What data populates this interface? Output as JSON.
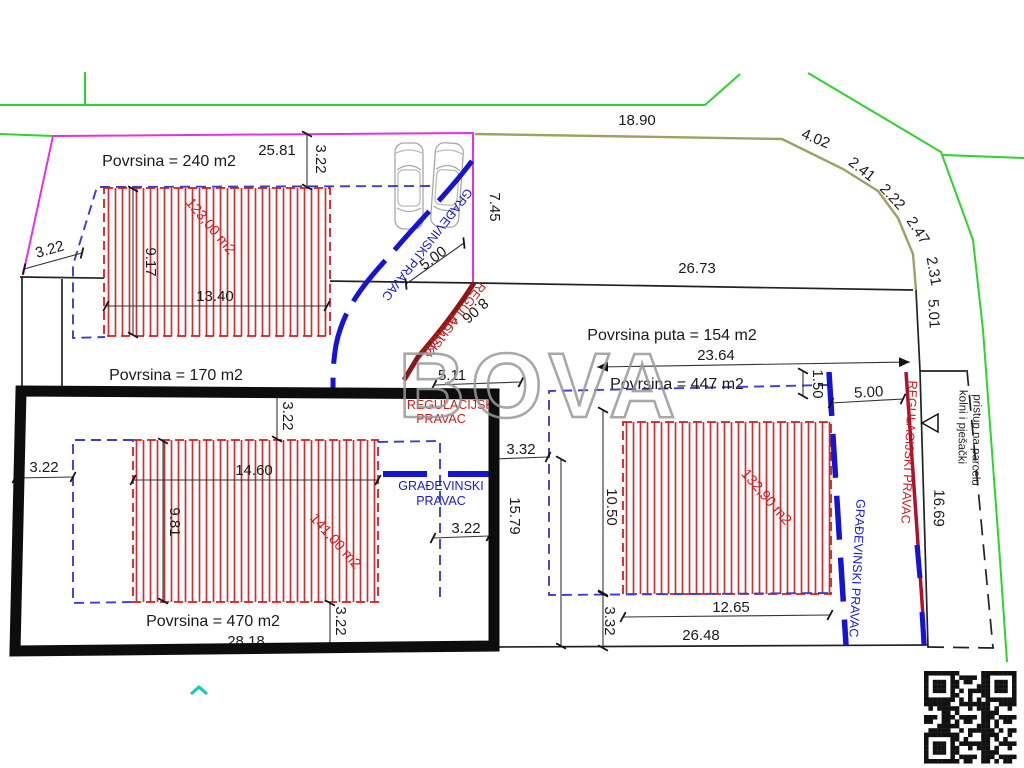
{
  "watermark": "BOVA",
  "parcels": {
    "p240": "Povrsina = 240 m2",
    "p170": "Povrsina = 170 m2",
    "p470": "Povrsina = 470 m2",
    "p447": "Povrsina = 447 m2",
    "road": "Povrsina puta = 154 m2"
  },
  "buildings": {
    "b123": "123,00 m2",
    "b141": "141,00 m2",
    "b132": "132,90 m2"
  },
  "dims": {
    "d2581": "25.81",
    "d322_top": "3.22",
    "d322_left": "3.22",
    "d1340": "13.40",
    "d917": "9.17",
    "d745": "7.45",
    "d500_diag": "5.00",
    "d806": "8.06",
    "d1890": "18.90",
    "d402": "4.02",
    "d241": "2.41",
    "d222": "2.22",
    "d247": "2.47",
    "d231": "2.31",
    "d501": "5.01",
    "d2673": "26.73",
    "d2364": "23.64",
    "d150": "1.50",
    "d500_right": "5.00",
    "d511": "5.11",
    "d332_mid": "3.32",
    "d1579": "15.79",
    "d322_b141_top": "3.22",
    "d322_b141_left": "3.22",
    "d1460": "14.60",
    "d981": "9.81",
    "d322_b141_right": "3.22",
    "d322_b141_bot": "3.22",
    "d2818": "28.18",
    "d1050": "10.50",
    "d332_right": "3.32",
    "d1265": "12.65",
    "d2648": "26.48",
    "d1669": "16.69"
  },
  "pravac": {
    "grad": "GRAĐEVINSKI PRAVAC",
    "grad1": "GRAĐEVINSKI",
    "reg": "REGULACIJSKI PRAVAC",
    "reg1": "REGULACIJSKI",
    "pravac": "PRAVAC"
  },
  "access": {
    "line1": "kolni i pješački",
    "line2": "pristup na parcelu"
  },
  "colors": {
    "road_green": "#2ed32e",
    "boundary_magenta": "#e431e4",
    "boundary_olive": "#a0a060",
    "pravac_blue": "#1414d2",
    "regulacijski_red": "#8c1616",
    "hatch_red": "#cc3030",
    "watermark_gray": "#9a9a9a"
  }
}
